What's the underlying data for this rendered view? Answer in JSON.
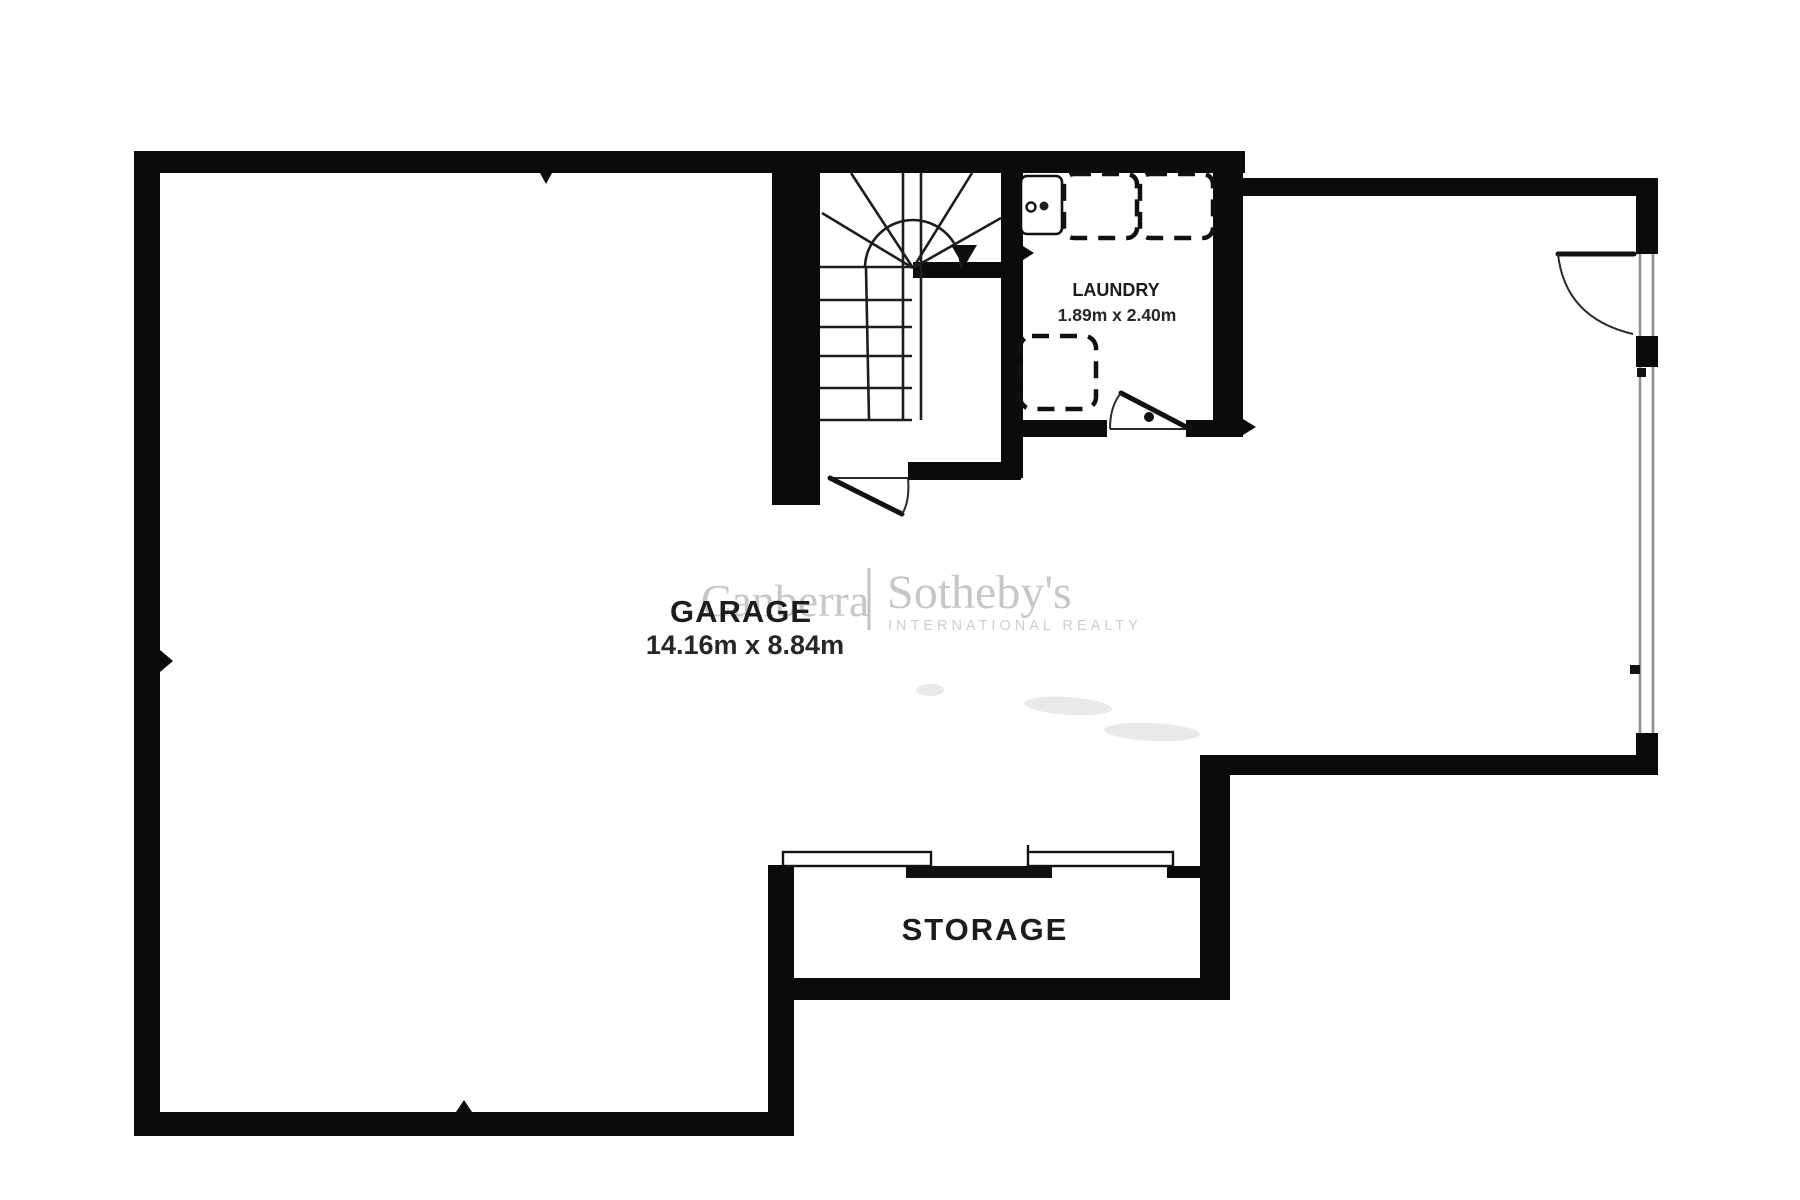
{
  "plan": {
    "title": "Garage level floor plan",
    "rooms": {
      "garage": {
        "name": "GARAGE",
        "dimensions": "14.16m x 8.84m"
      },
      "laundry": {
        "name": "LAUNDRY",
        "dimensions": "1.89m x 2.40m"
      },
      "storage": {
        "name": "STORAGE"
      }
    },
    "watermark": {
      "left": "Canberra",
      "right": "Sotheby's",
      "subtitle": "INTERNATIONAL REALTY"
    },
    "colors": {
      "wall": "#0b0b0b",
      "label": "#1c1c1c",
      "watermark_gray": "#c7c7c7",
      "background": "#ffffff"
    },
    "icons": {
      "stairs_direction_arrow": "down-triangle"
    }
  }
}
